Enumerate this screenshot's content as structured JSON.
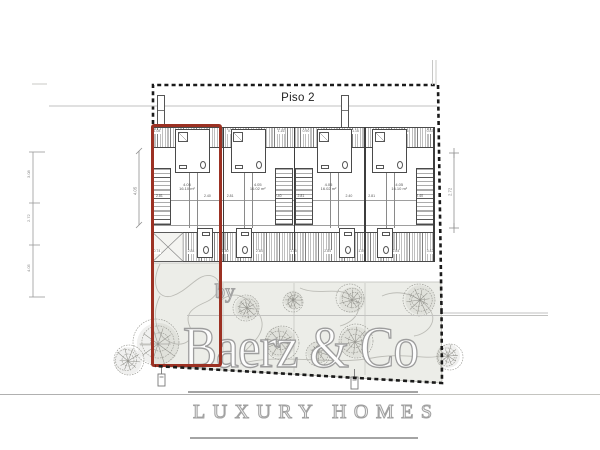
{
  "plan": {
    "floor_label": "Piso 2",
    "dim_right": "2.72",
    "dim_left_stair": "4.05",
    "dim_chain_left": [
      "3.08",
      "2.72",
      "4.05"
    ],
    "units": [
      {
        "dim": "4.05",
        "area": "16.10 m²",
        "w1": "2.81",
        "w2": "2.40"
      },
      {
        "dim": "4.05",
        "area": "16.02 m²",
        "w1": "2.81",
        "w2": "2.40"
      },
      {
        "dim": "4.05",
        "area": "16.02 m²",
        "w1": "2.81",
        "w2": "2.40"
      },
      {
        "dim": "4.05",
        "area": "16.10 m²",
        "w1": "2.81",
        "w2": "2.40"
      }
    ],
    "top_band_dims": [
      "1.08",
      "3.06",
      "1.16",
      "0.90",
      "3.06",
      "1.16",
      "0.90",
      "3.06",
      "1.16",
      "0.90",
      "3.06",
      "0.83"
    ],
    "bottom_band_dims": [
      "0.74",
      "2.84",
      "1.80",
      "2.84",
      "1.16",
      "2.84",
      "1.80",
      "2.84",
      "3.42"
    ]
  },
  "watermark": {
    "by": "by",
    "brand": "Baerz & Co",
    "tagline": "LUXURY HOMES"
  },
  "colors": {
    "highlight_red": "#9c3123",
    "boundary_black": "#1a1a1a",
    "garden_fill": "#ecede8",
    "watermark_gray": "#a2a2a2"
  }
}
